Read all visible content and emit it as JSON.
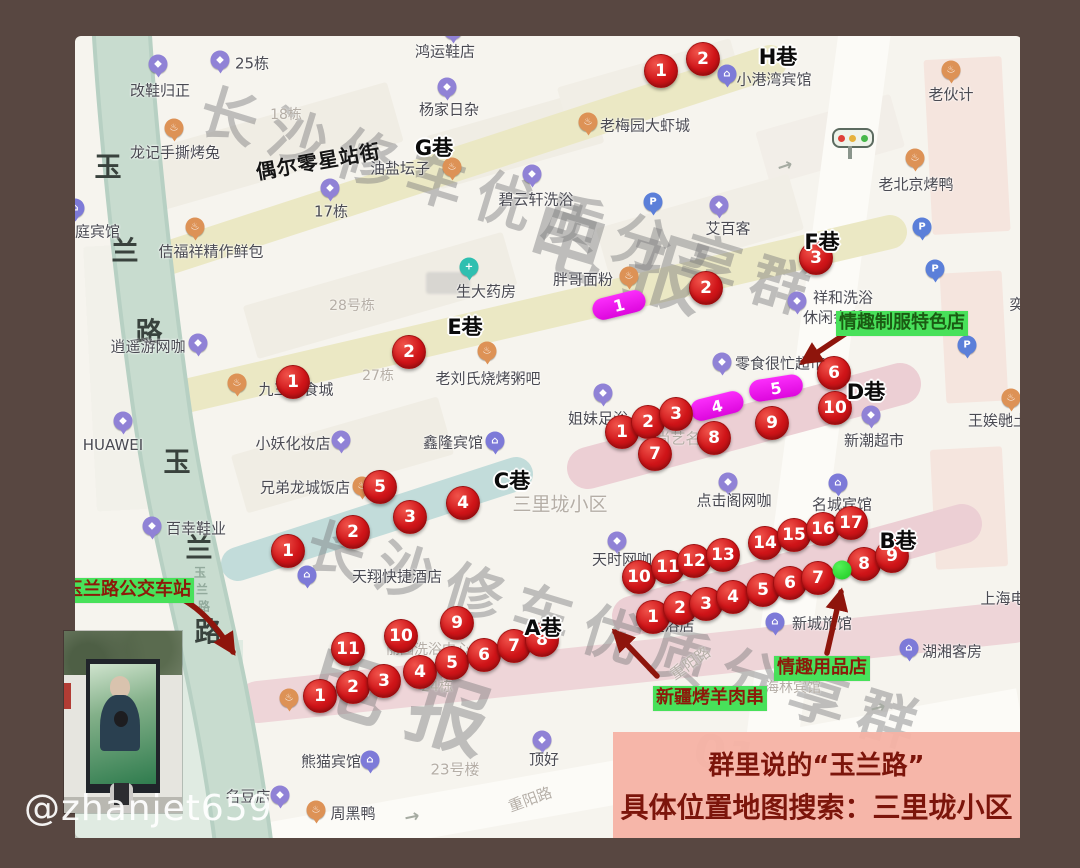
{
  "image_type": "annotated-map-photo",
  "handle": "@zhanjet659",
  "colors": {
    "frame_brown": "#584741",
    "map_bg": "#f6f4ee",
    "road_green": "#c5dacc",
    "band_yellow": "#ebe8c4",
    "band_pink": "#eccfd4",
    "band_teal": "#c2dcda",
    "marker_red": "#cf1418",
    "marker_magenta": "#ee16ee",
    "label_green_bg": "#48e15a",
    "banner_bg": "#f6b2a4",
    "banner_text": "#7c150b"
  },
  "banner": {
    "line1": "群里说的“玉兰路”",
    "line2": "具体位置地图搜索：三里垅小区"
  },
  "watermarks": {
    "top": {
      "text": "长沙修车优质分享群",
      "sub": "电报"
    },
    "bottom": {
      "text": "长沙修车优质分享群",
      "sub": "电报",
      "extra": "01"
    }
  },
  "green_labels": {
    "uniform_shop": {
      "text": "情趣制服特色店",
      "x": 900,
      "y": 323
    },
    "bus_station": {
      "text": "玉兰路公交车站",
      "x": 125,
      "y": 591
    },
    "bbq": {
      "text": "新疆烤羊肉串",
      "x": 710,
      "y": 696
    },
    "adult_shop": {
      "text": "情趣用品店",
      "x": 821,
      "y": 667
    }
  },
  "street_annotation": {
    "text": "偶尔零星站街",
    "x": 318,
    "y": 160,
    "rotation": -10
  },
  "lanes": [
    [
      "H巷",
      778,
      56
    ],
    [
      "G巷",
      434,
      147
    ],
    [
      "F巷",
      822,
      241
    ],
    [
      "E巷",
      465,
      326
    ],
    [
      "D巷",
      866,
      391
    ],
    [
      "C巷",
      512,
      480
    ],
    [
      "B巷",
      898,
      540
    ],
    [
      "A巷",
      543,
      627
    ]
  ],
  "road_name_large": [
    [
      "玉",
      108,
      165
    ],
    [
      "兰",
      125,
      249
    ],
    [
      "路",
      149,
      330
    ],
    [
      "玉",
      177,
      460
    ],
    [
      "兰",
      199,
      546
    ],
    [
      "路",
      208,
      630
    ]
  ],
  "road_name_small": {
    "text": "玉兰路",
    "x": 200,
    "y": 572
  },
  "red_markers": {
    "H": [
      [
        1,
        661,
        71
      ],
      [
        2,
        703,
        59
      ]
    ],
    "F": [
      [
        2,
        706,
        288
      ],
      [
        3,
        816,
        258
      ]
    ],
    "E": [
      [
        1,
        293,
        382
      ],
      [
        2,
        409,
        352
      ]
    ],
    "D": [
      [
        1,
        622,
        432
      ],
      [
        2,
        648,
        422
      ],
      [
        3,
        676,
        414
      ],
      [
        6,
        834,
        373
      ],
      [
        7,
        655,
        454
      ],
      [
        8,
        714,
        438
      ],
      [
        9,
        772,
        423
      ],
      [
        10,
        835,
        408
      ]
    ],
    "C": [
      [
        1,
        288,
        551
      ],
      [
        2,
        353,
        532
      ],
      [
        3,
        410,
        517
      ],
      [
        4,
        463,
        503
      ],
      [
        5,
        380,
        487
      ]
    ],
    "B": [
      [
        1,
        653,
        617
      ],
      [
        2,
        680,
        608
      ],
      [
        3,
        706,
        604
      ],
      [
        4,
        733,
        597
      ],
      [
        5,
        763,
        590
      ],
      [
        6,
        790,
        583
      ],
      [
        7,
        818,
        578
      ],
      [
        8,
        864,
        564
      ],
      [
        9,
        892,
        556
      ],
      [
        10,
        639,
        577
      ],
      [
        11,
        668,
        567
      ],
      [
        12,
        694,
        561
      ],
      [
        13,
        723,
        555
      ],
      [
        14,
        765,
        543
      ],
      [
        15,
        794,
        535
      ],
      [
        16,
        823,
        529
      ],
      [
        17,
        851,
        523
      ]
    ],
    "A": [
      [
        1,
        320,
        696
      ],
      [
        2,
        353,
        687
      ],
      [
        3,
        384,
        681
      ],
      [
        4,
        420,
        672
      ],
      [
        5,
        452,
        663
      ],
      [
        6,
        484,
        655
      ],
      [
        7,
        514,
        646
      ],
      [
        8,
        542,
        640
      ],
      [
        9,
        457,
        623
      ],
      [
        10,
        401,
        636
      ],
      [
        11,
        348,
        649
      ]
    ]
  },
  "magenta_markers": [
    [
      1,
      619,
      305,
      -14
    ],
    [
      4,
      717,
      406,
      -14
    ],
    [
      5,
      776,
      388,
      -9
    ]
  ],
  "green_dot": {
    "x": 842,
    "y": 570
  },
  "icon_colors": {
    "shop": "#9082d6",
    "hotel": "#7d7ad8",
    "food": "#dd9256",
    "pharmacy": "#2fbfb0",
    "parking": "#5b7fd9"
  },
  "icon_glyphs": {
    "shop": "◆",
    "hotel": "⌂",
    "food": "♨",
    "pharmacy": "+",
    "parking": "P"
  },
  "pois": [
    {
      "label": "改鞋归正",
      "lx": 160,
      "ly": 90,
      "icon": "shop",
      "ix": 158,
      "iy": 64
    },
    {
      "label": "25栋",
      "lx": 252,
      "ly": 63,
      "icon": "shop",
      "ix": 220,
      "iy": 60
    },
    {
      "label": "鸿运鞋店",
      "lx": 445,
      "ly": 51,
      "icon": "shop",
      "ix": 453,
      "iy": 30
    },
    {
      "label": "杨家日杂",
      "lx": 449,
      "ly": 109,
      "icon": "shop",
      "ix": 447,
      "iy": 87
    },
    {
      "label": "小港湾宾馆",
      "lx": 774,
      "ly": 79,
      "icon": "hotel",
      "ix": 727,
      "iy": 74
    },
    {
      "label": "老伙计",
      "lx": 951,
      "ly": 94,
      "icon": "food",
      "ix": 951,
      "iy": 70
    },
    {
      "label": "老北京烤鸭",
      "lx": 916,
      "ly": 184,
      "icon": "food",
      "ix": 915,
      "iy": 158
    },
    {
      "label": "龙记手撕烤兔",
      "lx": 175,
      "ly": 152,
      "icon": "food",
      "ix": 174,
      "iy": 128
    },
    {
      "label": "家庭宾馆",
      "lx": 90,
      "ly": 231,
      "icon": "hotel",
      "ix": 75,
      "iy": 208
    },
    {
      "label": "佶福祥精作鲜包",
      "lx": 211,
      "ly": 251,
      "icon": "food",
      "ix": 195,
      "iy": 227
    },
    {
      "label": "17栋",
      "lx": 331,
      "ly": 211,
      "icon": "shop",
      "ix": 330,
      "iy": 188
    },
    {
      "label": "油盐坛子",
      "lx": 400,
      "ly": 168,
      "icon": "food",
      "ix": 452,
      "iy": 167
    },
    {
      "label": "碧云轩洗浴",
      "lx": 536,
      "ly": 199,
      "icon": "shop",
      "ix": 532,
      "iy": 174
    },
    {
      "label": "老梅园大虾城",
      "lx": 645,
      "ly": 125,
      "icon": "food",
      "ix": 588,
      "iy": 122
    },
    {
      "label": "艾百客",
      "lx": 728,
      "ly": 228,
      "icon": "shop",
      "ix": 719,
      "iy": 205
    },
    {
      "label": "胖哥面粉",
      "lx": 583,
      "ly": 279,
      "icon": "food",
      "ix": 629,
      "iy": 276
    },
    {
      "label": "祥和洗浴",
      "lx": 843,
      "ly": 297,
      "icon": "shop",
      "ix": 797,
      "iy": 301
    },
    {
      "label": "休闲会所",
      "lx": 833,
      "ly": 317,
      "icon": "none"
    },
    {
      "label": "生大药房",
      "lx": 486,
      "ly": 291,
      "icon": "pharmacy",
      "ix": 469,
      "iy": 267
    },
    {
      "label": "逍遥游网咖",
      "lx": 148,
      "ly": 346,
      "icon": "shop",
      "ix": 198,
      "iy": 343
    },
    {
      "label": "九三美食城",
      "lx": 296,
      "ly": 389,
      "icon": "food",
      "ix": 237,
      "iy": 383
    },
    {
      "label": "HUAWEI",
      "lx": 113,
      "ly": 445,
      "icon": "shop",
      "ix": 123,
      "iy": 421
    },
    {
      "label": "老刘氏烧烤粥吧",
      "lx": 488,
      "ly": 378,
      "icon": "food",
      "ix": 487,
      "iy": 351
    },
    {
      "label": "小妖化妆店",
      "lx": 293,
      "ly": 443,
      "icon": "shop",
      "ix": 341,
      "iy": 440
    },
    {
      "label": "鑫隆宾馆",
      "lx": 453,
      "ly": 442,
      "icon": "hotel",
      "ix": 495,
      "iy": 441
    },
    {
      "label": "零食很忙超市",
      "lx": 780,
      "ly": 363,
      "icon": "shop",
      "ix": 722,
      "iy": 362
    },
    {
      "label": "姐妹足浴",
      "lx": 598,
      "ly": 418,
      "icon": "shop",
      "ix": 603,
      "iy": 393
    },
    {
      "label": "新潮超市",
      "lx": 874,
      "ly": 440,
      "icon": "shop",
      "ix": 871,
      "iy": 415
    },
    {
      "label": "王娭毑土",
      "lx": 998,
      "ly": 420,
      "icon": "food",
      "ix": 1011,
      "iy": 398
    },
    {
      "label": "兄弟龙城饭店",
      "lx": 305,
      "ly": 487,
      "icon": "food",
      "ix": 362,
      "iy": 486
    },
    {
      "label": "百幸鞋业",
      "lx": 196,
      "ly": 528,
      "icon": "shop",
      "ix": 152,
      "iy": 526
    },
    {
      "label": "点击阁网咖",
      "lx": 734,
      "ly": 500,
      "icon": "shop",
      "ix": 728,
      "iy": 482
    },
    {
      "label": "名城宾馆",
      "lx": 842,
      "ly": 504,
      "icon": "hotel",
      "ix": 838,
      "iy": 483
    },
    {
      "label": "天时网咖",
      "lx": 622,
      "ly": 559,
      "icon": "shop",
      "ix": 617,
      "iy": 541
    },
    {
      "label": "天翔快捷酒店",
      "lx": 397,
      "ly": 576,
      "icon": "hotel",
      "ix": 307,
      "iy": 575
    },
    {
      "label": "淀浴店",
      "lx": 672,
      "ly": 625,
      "icon": "none"
    },
    {
      "label": "新城旅馆",
      "lx": 822,
      "ly": 623,
      "icon": "hotel",
      "ix": 775,
      "iy": 622
    },
    {
      "label": "湖湘客房",
      "lx": 952,
      "ly": 651,
      "icon": "hotel",
      "ix": 909,
      "iy": 648
    },
    {
      "label": "上海电",
      "lx": 1003,
      "ly": 598,
      "icon": "none"
    },
    {
      "label": "熊猫宾馆",
      "lx": 331,
      "ly": 761,
      "icon": "hotel",
      "ix": 370,
      "iy": 760
    },
    {
      "label": "顶好",
      "lx": 544,
      "ly": 759,
      "icon": "shop",
      "ix": 542,
      "iy": 740
    },
    {
      "label": "名豆店",
      "lx": 248,
      "ly": 796,
      "icon": "shop",
      "ix": 280,
      "iy": 795
    },
    {
      "label": "周黑鸭",
      "lx": 353,
      "ly": 813,
      "icon": "food",
      "ix": 316,
      "iy": 810
    },
    {
      "label": "奕",
      "lx": 1017,
      "ly": 304,
      "icon": "none"
    },
    {
      "label": "",
      "lx": 0,
      "ly": 0,
      "icon": "food",
      "ix": 289,
      "iy": 698
    }
  ],
  "parking_icons": [
    [
      653,
      202
    ],
    [
      922,
      227
    ],
    [
      935,
      269
    ],
    [
      967,
      345
    ]
  ],
  "gray_texts": [
    [
      "18栋",
      286,
      114,
      0,
      14
    ],
    [
      "28号栋",
      352,
      305,
      0,
      14
    ],
    [
      "27栋",
      378,
      375,
      0,
      14
    ],
    [
      "尚艺名",
      678,
      438,
      0,
      15
    ],
    [
      "丽园洗浴中心",
      428,
      649,
      0,
      14
    ],
    [
      "24栋",
      437,
      686,
      0,
      14
    ],
    [
      "23号楼",
      455,
      769,
      0,
      15
    ],
    [
      "三里垅小区",
      560,
      503,
      0,
      19
    ],
    [
      "重阳路",
      690,
      663,
      -35,
      15
    ],
    [
      "重阳路",
      530,
      799,
      -20,
      15
    ],
    [
      "海林宾馆",
      793,
      687,
      0,
      14
    ]
  ],
  "road_arrows": [
    [
      785,
      166,
      -18
    ],
    [
      412,
      817,
      -12
    ],
    [
      878,
      708,
      -15
    ]
  ]
}
